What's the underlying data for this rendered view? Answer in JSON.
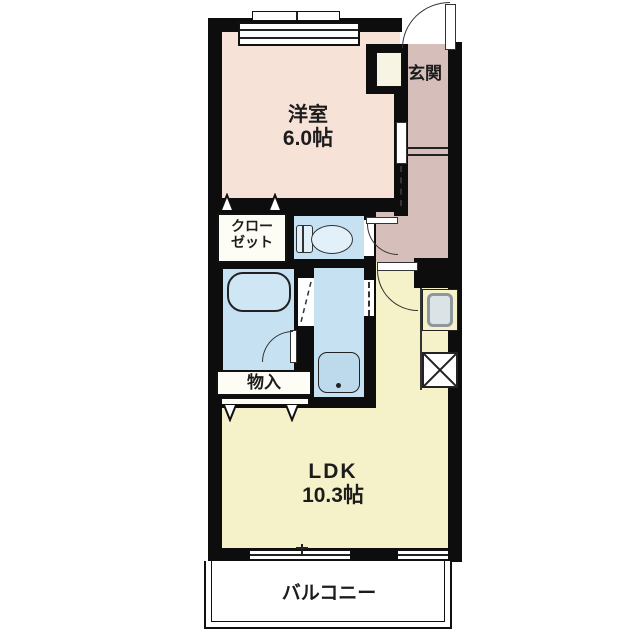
{
  "floorplan": {
    "rooms": {
      "western": {
        "name": "洋室",
        "size": "6.0帖"
      },
      "entrance": {
        "name": "玄関"
      },
      "closet": {
        "line1": "クロー",
        "line2": "ゼット"
      },
      "storage": {
        "name": "物入"
      },
      "ldk": {
        "name": "LDK",
        "size": "10.3帖"
      },
      "balcony": {
        "name": "バルコニー"
      }
    },
    "fixtures": [
      "entrance-door",
      "toilet",
      "bathtub",
      "bath-folding-door",
      "washbasin",
      "kitchen-sink",
      "refrigerator-space",
      "sliding-window",
      "closet-folding-doors"
    ],
    "colors": {
      "wall": "#0d0d0d",
      "western_room": "#f7e2d8",
      "hallway": "#d6beba",
      "wet_area": "#c6e1f2",
      "ldk": "#f5f2c9",
      "fixture_blue": "#e2f0fa",
      "sink_gray": "#8e979e"
    }
  }
}
